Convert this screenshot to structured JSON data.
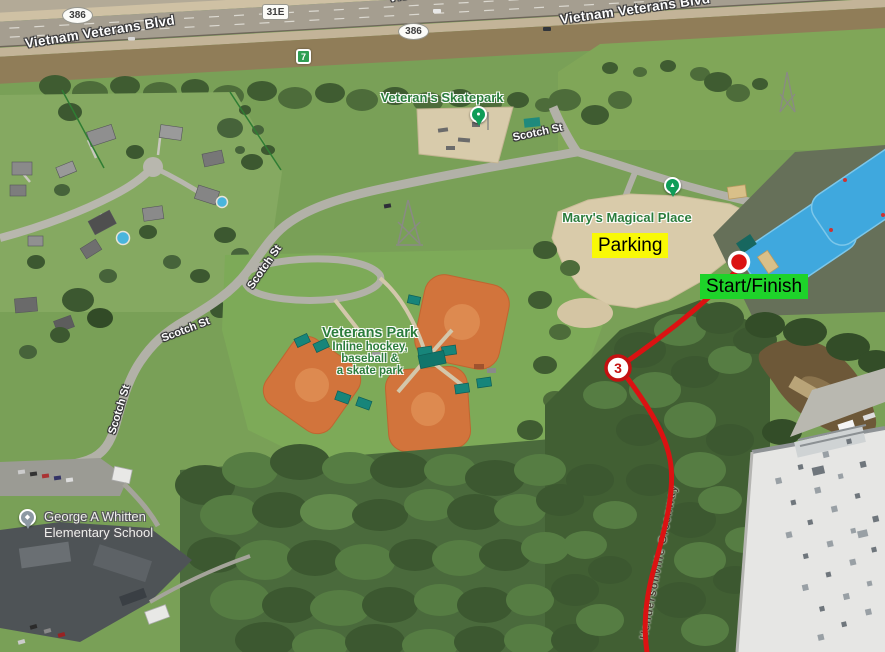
{
  "map": {
    "road_labels": {
      "blvd": "Vietnam Veterans Blvd",
      "scotch": "Scotch St",
      "greenway": "Hendersonville Greenway"
    },
    "shields": {
      "s386": "386",
      "s31e": "31E",
      "s7": "7"
    },
    "pois": {
      "skatepark": "Veteran's Skatepark",
      "marys": "Mary's Magical Place",
      "park_title": "Veterans Park",
      "park_sub1": "Inline hockey,",
      "park_sub2": "baseball &",
      "park_sub3": "a skate park",
      "school1": "George A Whitten",
      "school2": "Elementary School"
    },
    "race": {
      "parking": "Parking",
      "start_finish": "Start/Finish",
      "mile_marker": "3",
      "route_color": "#db1212",
      "parking_bg": "#f9f906",
      "start_bg": "#1ed32a"
    }
  }
}
